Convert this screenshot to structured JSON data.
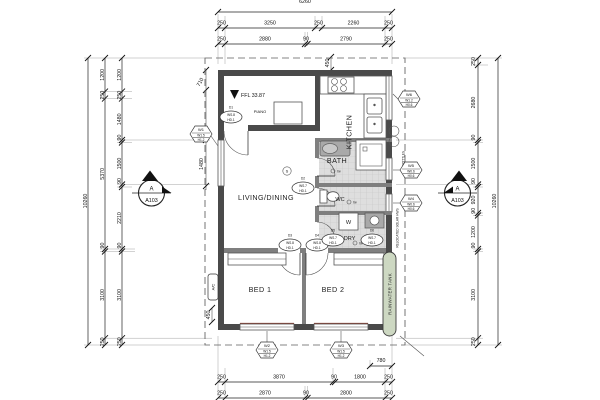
{
  "drawing": {
    "type": "floor-plan"
  },
  "dims": {
    "top_total": "6260",
    "top1": [
      "250",
      "3250",
      "250",
      "2260",
      "250"
    ],
    "top2": [
      "250",
      "2880",
      "90",
      "2790",
      "250"
    ],
    "bot_780": "780",
    "bot1": [
      "250",
      "3870",
      "90",
      "1800",
      "250"
    ],
    "bot2": [
      "250",
      "2870",
      "90",
      "2800",
      "250"
    ],
    "left_total": "10260",
    "left_mid": [
      "1200",
      "250",
      "5370",
      "90",
      "3100",
      "250"
    ],
    "left_inner": [
      "1200",
      "250",
      "1480",
      "90",
      "1500",
      "90",
      "2210",
      "90",
      "3100",
      "250"
    ],
    "right_total": "10260",
    "right_inner": [
      "250",
      "2680",
      "90",
      "1500",
      "90",
      "920",
      "90",
      "1200",
      "90",
      "3100",
      "250"
    ],
    "d710": "710",
    "d1480": "1480",
    "d450_left": "450",
    "d450_top": "450",
    "d450_diag": "450",
    "d900": "900"
  },
  "rooms": {
    "living": "LIVING/DINING",
    "kitchen": "KITCHEN",
    "bath": "BATH",
    "wc": "WC",
    "laundry": "LDRY",
    "bed1": "BED 1",
    "bed2": "BED 2"
  },
  "ann": {
    "ffl": "FFL 33.87",
    "piano": "PIANO",
    "washer": "W",
    "smoke": "S",
    "fw": "fw",
    "ac": "A/C",
    "tank": "RAINWATER TANK",
    "gas": "GAS BOTTLES",
    "hws": "RELOCATED SOLAR HWS"
  },
  "marker": {
    "letter": "A",
    "sheet": "A103"
  },
  "wtags": [
    {
      "id": "W1",
      "w": "W1.5",
      "h": "H1.2"
    },
    {
      "id": "W2",
      "w": "W1.5",
      "h": "H1.2"
    },
    {
      "id": "W3",
      "w": "W1.5",
      "h": "H1.2"
    },
    {
      "id": "W4",
      "w": "W0.6",
      "h": "H0.6"
    },
    {
      "id": "W5",
      "w": "W0.6",
      "h": "H0.6"
    },
    {
      "id": "W6",
      "w": "W1.2",
      "h": "H0.6"
    }
  ],
  "dtags": [
    {
      "id": "D1",
      "a": "WS.8",
      "b": "HD.1"
    },
    {
      "id": "D2",
      "a": "WS.7",
      "b": "HD.1"
    },
    {
      "id": "D3",
      "a": "WS.8",
      "b": "HD.1"
    },
    {
      "id": "D4",
      "a": "WS.8",
      "b": "HD.1"
    },
    {
      "id": "D5",
      "a": "WS.7",
      "b": "HD.1"
    },
    {
      "id": "D6",
      "a": "WS.7",
      "b": "HD.1"
    }
  ],
  "colors": {
    "wall": "#4a4a4a",
    "tank_green": "#cdd8c2",
    "brick_red": "#8a3a2c"
  }
}
